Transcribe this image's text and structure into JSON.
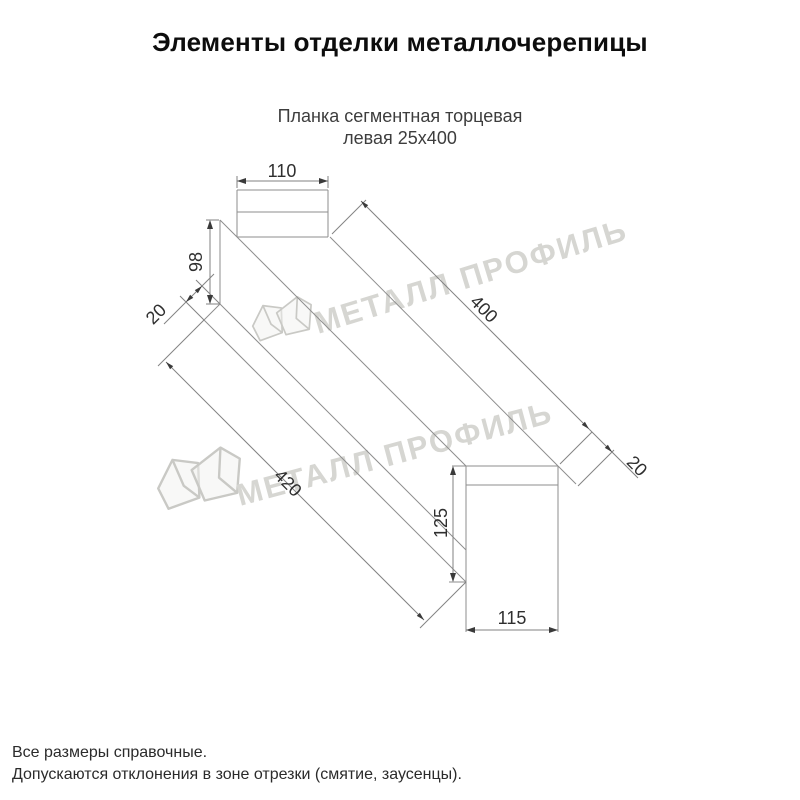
{
  "page": {
    "title": "Элементы отделки металлочерепицы"
  },
  "product": {
    "name_line1": "Планка сегментная торцевая",
    "name_line2": "левая 25х400"
  },
  "diagram": {
    "type": "technical-drawing",
    "dimensions": {
      "flange_width_top": "110",
      "far_end_height": "98",
      "far_hem": "20",
      "top_edge_length": "400",
      "near_hem": "20",
      "bottom_edge_length": "420",
      "near_end_height": "125",
      "near_end_width": "115"
    }
  },
  "watermark": {
    "brand": "МЕТАЛЛ ПРОФИЛЬ"
  },
  "footer": {
    "note1": "Все размеры справочные.",
    "note2": "Допускаются отклонения в зоне отрезки (смятие, заусенцы)."
  },
  "colors": {
    "part_line": "#8e8e8e",
    "dimension_line": "#828282",
    "dimension_text": "#2f2f2f",
    "watermark": "#d6d6d2",
    "title_text": "#0d0d0d"
  }
}
